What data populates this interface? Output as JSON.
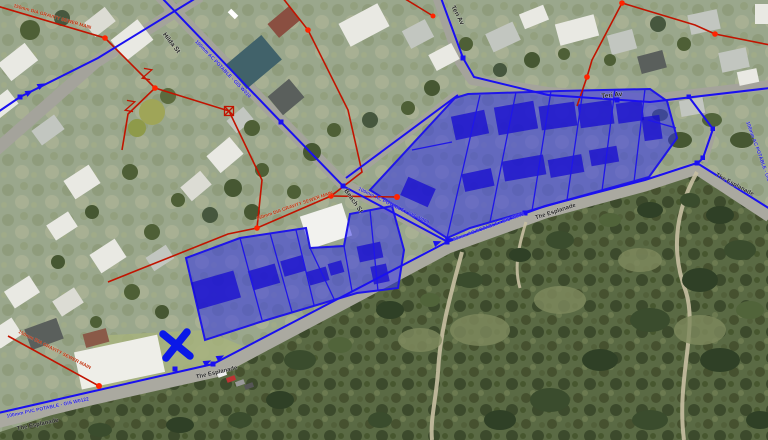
{
  "map": {
    "description": "GIS aerial viewer with selected parcels and utility networks",
    "street_labels": [
      {
        "id": "hilda",
        "text": "Hilda St"
      },
      {
        "id": "teri-upper",
        "text": "Teri Av"
      },
      {
        "id": "teri-main",
        "text": "Teri Av"
      },
      {
        "id": "beach",
        "text": "Beach St"
      },
      {
        "id": "esplanade-sw",
        "text": "The Esplanade"
      },
      {
        "id": "esplanade-mid",
        "text": "The Esplanade"
      },
      {
        "id": "esplanade-east",
        "text": "The Esplanade"
      },
      {
        "id": "esplanade-bend",
        "text": "The Esplanade"
      }
    ],
    "water_main_labels": [
      {
        "text": "100mm AC POTABLE - GIS W010"
      },
      {
        "text": "100mm AC POTABLE - GIS W009"
      },
      {
        "text": "80mm AC POTABLE - GIS W012"
      },
      {
        "text": "100mm PVC POTABLE - GIS W0122"
      },
      {
        "text": "100mm AC POTABLE - GIS"
      }
    ],
    "sewer_labels": [
      {
        "text": "150mm DIA GRAVITY SEWER MAIN"
      },
      {
        "text": "150mm DIA GRAVITY SEWER MAIN"
      },
      {
        "text": "150mm DIA GRAVITY SEWER MAIN"
      }
    ],
    "legend_colors": {
      "water_main": "#1a10f0",
      "sewer_main": "#c11400",
      "selected_parcel_fill": "#2b2bf0",
      "selected_parcel_stroke": "#1f16e8",
      "selection_marker": "#0a18e8"
    },
    "selection": {
      "marker": "cross",
      "left_group_parcels": 7,
      "right_group_parcels": 9
    }
  }
}
